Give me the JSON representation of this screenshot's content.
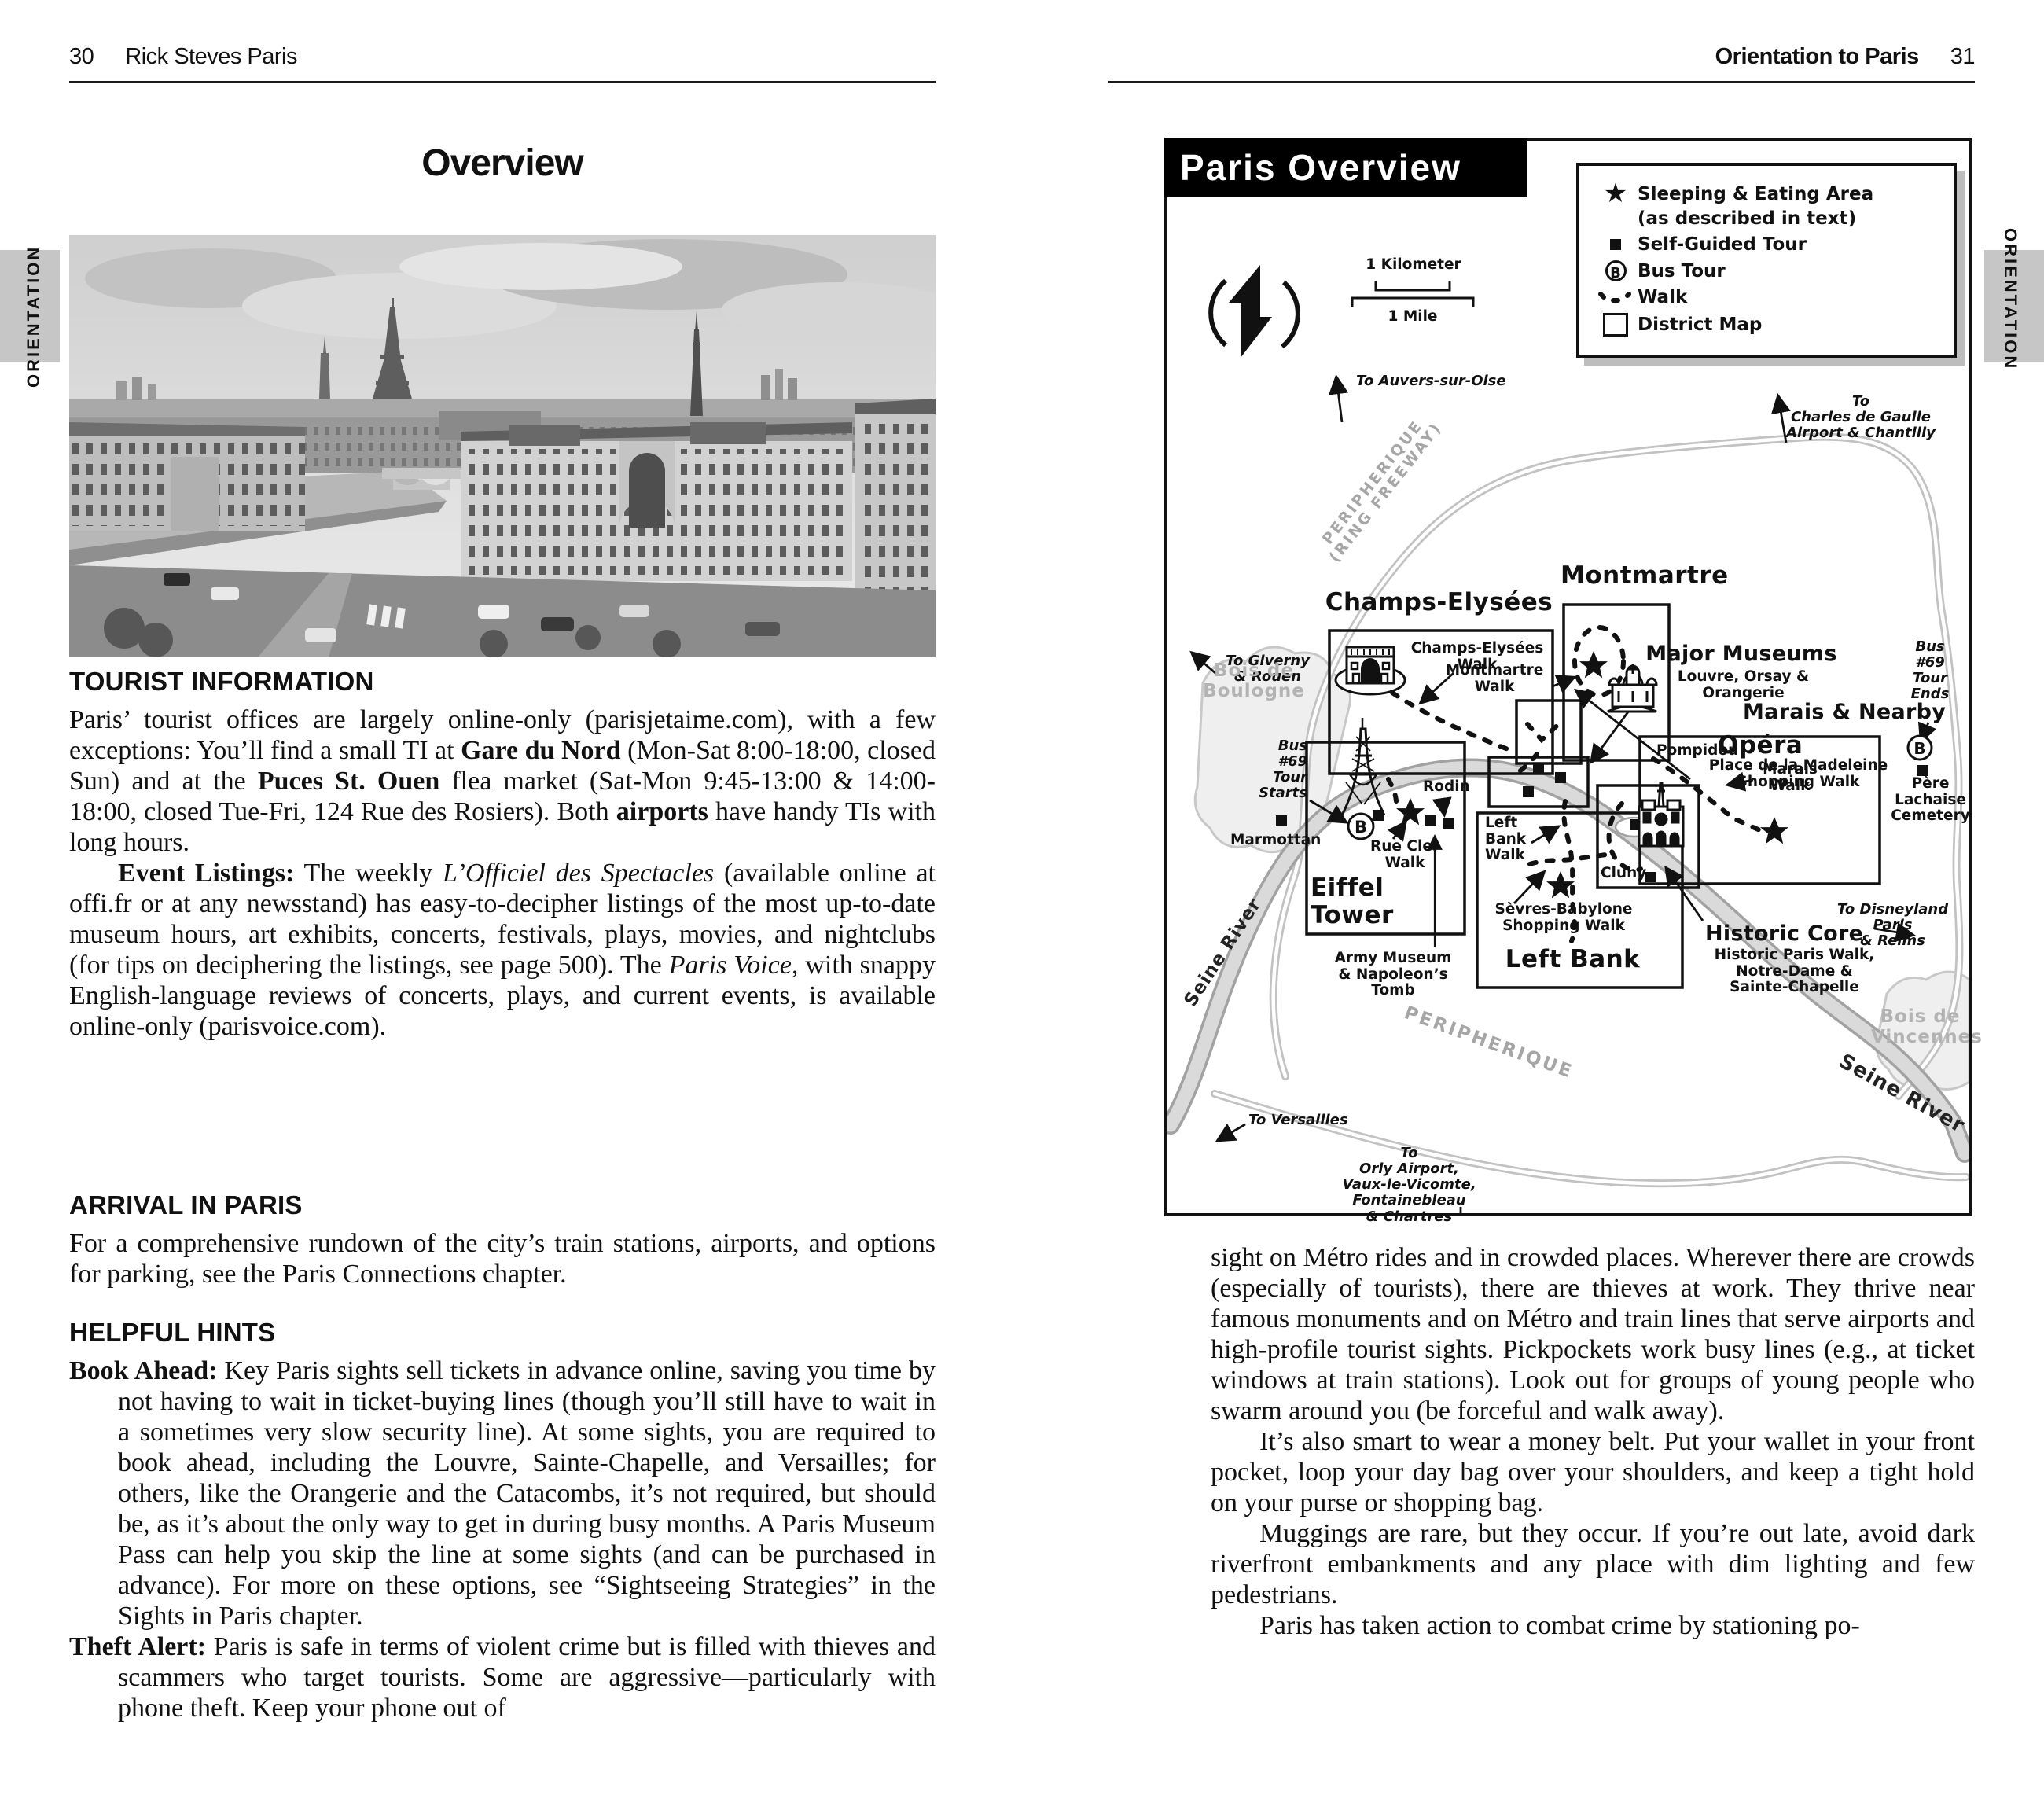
{
  "page_left": {
    "header": {
      "page_number": "30",
      "title": "Rick Steves Paris"
    },
    "side_tab": "ORIENTATION",
    "title": "Overview",
    "tourist_information": {
      "heading": "TOURIST INFORMATION",
      "para1": "Paris’ tourist offices are largely online-only (parisjetaime.com), with a few exceptions: You’ll find a small TI at **Gare du Nord** (Mon-Sat 8:00-18:00, closed Sun) and at the **Puces St. Ouen** flea market (Sat-Mon 9:45-13:00 & 14:00-18:00, closed Tue-Fri, 124 Rue des Rosiers). Both **airports** have handy TIs with long hours.",
      "para2": "**Event Listings:** The weekly *L’Officiel des Spectacles* (available online at offi.fr or at any newsstand) has easy-to-decipher listings of the most up-to-date museum hours, art exhibits, concerts, festivals, plays, movies, and nightclubs (for tips on deciphering the listings, see page 500). The *Paris Voice,* with snappy English-language reviews of concerts, plays, and current events, is available online-only (parisvoice.com)."
    },
    "arrival": {
      "heading": "ARRIVAL IN PARIS",
      "para1": "For a comprehensive rundown of the city’s train stations, airports, and options for parking, see the Paris Connections chapter."
    },
    "helpful_hints": {
      "heading": "HELPFUL HINTS",
      "para1": "**Book Ahead:** Key Paris sights sell tickets in advance online, saving you time by not having to wait in ticket-buying lines (though you’ll still have to wait in a sometimes very slow security line). At some sights, you are required to book ahead, including the Louvre, Sainte-Chapelle, and Versailles; for others, like the Orangerie and the Catacombs, it’s not required, but should be, as it’s about the only way to get in during busy months. A Paris Museum Pass can help you skip the line at some sights (and can be purchased in advance). For more on these options, see “Sightseeing Strategies” in the Sights in Paris chapter.",
      "para2": "**Theft Alert:** Paris is safe in terms of violent crime but is filled with thieves and scammers who target tourists. Some are aggressive—particularly with phone theft. Keep your phone out of"
    }
  },
  "page_right": {
    "header": {
      "title": "Orientation to Paris",
      "page_number": "31"
    },
    "side_tab": "ORIENTATION",
    "map": {
      "title": "Paris Overview",
      "legend": {
        "sleeping": "Sleeping & Eating Area",
        "sleeping_sub": "(as described in text)",
        "self_guided": "Self-Guided Tour",
        "bus_tour": "Bus Tour",
        "bus_letter": "B",
        "walk": "Walk",
        "district": "District Map"
      },
      "scale": {
        "km": "1 Kilometer",
        "mile": "1 Mile"
      },
      "labels": {
        "to_auvers": "To Auvers-sur-Oise",
        "to_cdg": "To\nCharles de Gaulle\nAirport & Chantilly",
        "to_giverny": "To Giverny\n& Rouen",
        "to_versailles": "To Versailles",
        "to_disneyland": "To Disneyland Paris\n& Reims",
        "to_orly": "To\nOrly Airport,\nVaux-le-Vicomte,\nFontainebleau\n& Chartres",
        "periph_nw": "PERIPHERIQUE\n(RING FREEWAY)",
        "periph_s": "PERIPHERIQUE",
        "montmartre": "Montmartre",
        "montmartre_walk": "Montmartre\nWalk",
        "opera": "Opéra",
        "madeleine_walk": "Place de la Madeleine\nShopping Walk",
        "champs": "Champs-Elysées",
        "champs_walk": "Champs-Elysées\nWalk",
        "major_museums": "Major Museums",
        "major_museums_sub": "Louvre, Orsay & Orangerie",
        "marais": "Marais & Nearby",
        "pompidou": "Pompidou",
        "marais_walk": "Marais\nWalk",
        "bus69_ends": "Bus\n#69\nTour\nEnds",
        "pere_lachaise": "Père\nLachaise\nCemetery",
        "historic_core": "Historic Core",
        "historic_core_sub": "Historic Paris Walk,\nNotre-Dame &\nSainte-Chapelle",
        "cluny": "Cluny",
        "left_bank": "Left Bank",
        "left_bank_walk": "Left\nBank\nWalk",
        "sevres": "Sèvres-Babylone\nShopping Walk",
        "eiffel": "Eiffel\nTower",
        "rodin": "Rodin",
        "rue_cler": "Rue Cler\nWalk",
        "army": "Army Museum\n& Napoleon’s\nTomb",
        "bus69_starts": "Bus\n#69\nTour\nStarts",
        "marmottan": "Marmottan",
        "bois_boulogne": "Bois de\nBoulogne",
        "bois_vincennes": "Bois de\nVincennes",
        "seine_w": "Seine River",
        "seine_se": "Seine River"
      }
    },
    "body": {
      "para1": "sight on Métro rides and in crowded places. Wherever there are crowds (especially of tourists), there are thieves at work. They thrive near famous monuments and on Métro and train lines that serve airports and high-profile tourist sights. Pickpockets work busy lines (e.g., at ticket windows at train stations). Look out for groups of young people who swarm around you (be forceful and walk away).",
      "para2": "It’s also smart to wear a money belt. Put your wallet in your front pocket, loop your day bag over your shoulders, and keep a tight hold on your purse or shopping bag.",
      "para3": "Muggings are rare, but they occur. If you’re out late, avoid dark riverfront embankments and any place with dim lighting and few pedestrians.",
      "para4": "Paris has taken action to combat crime by stationing po-"
    }
  }
}
